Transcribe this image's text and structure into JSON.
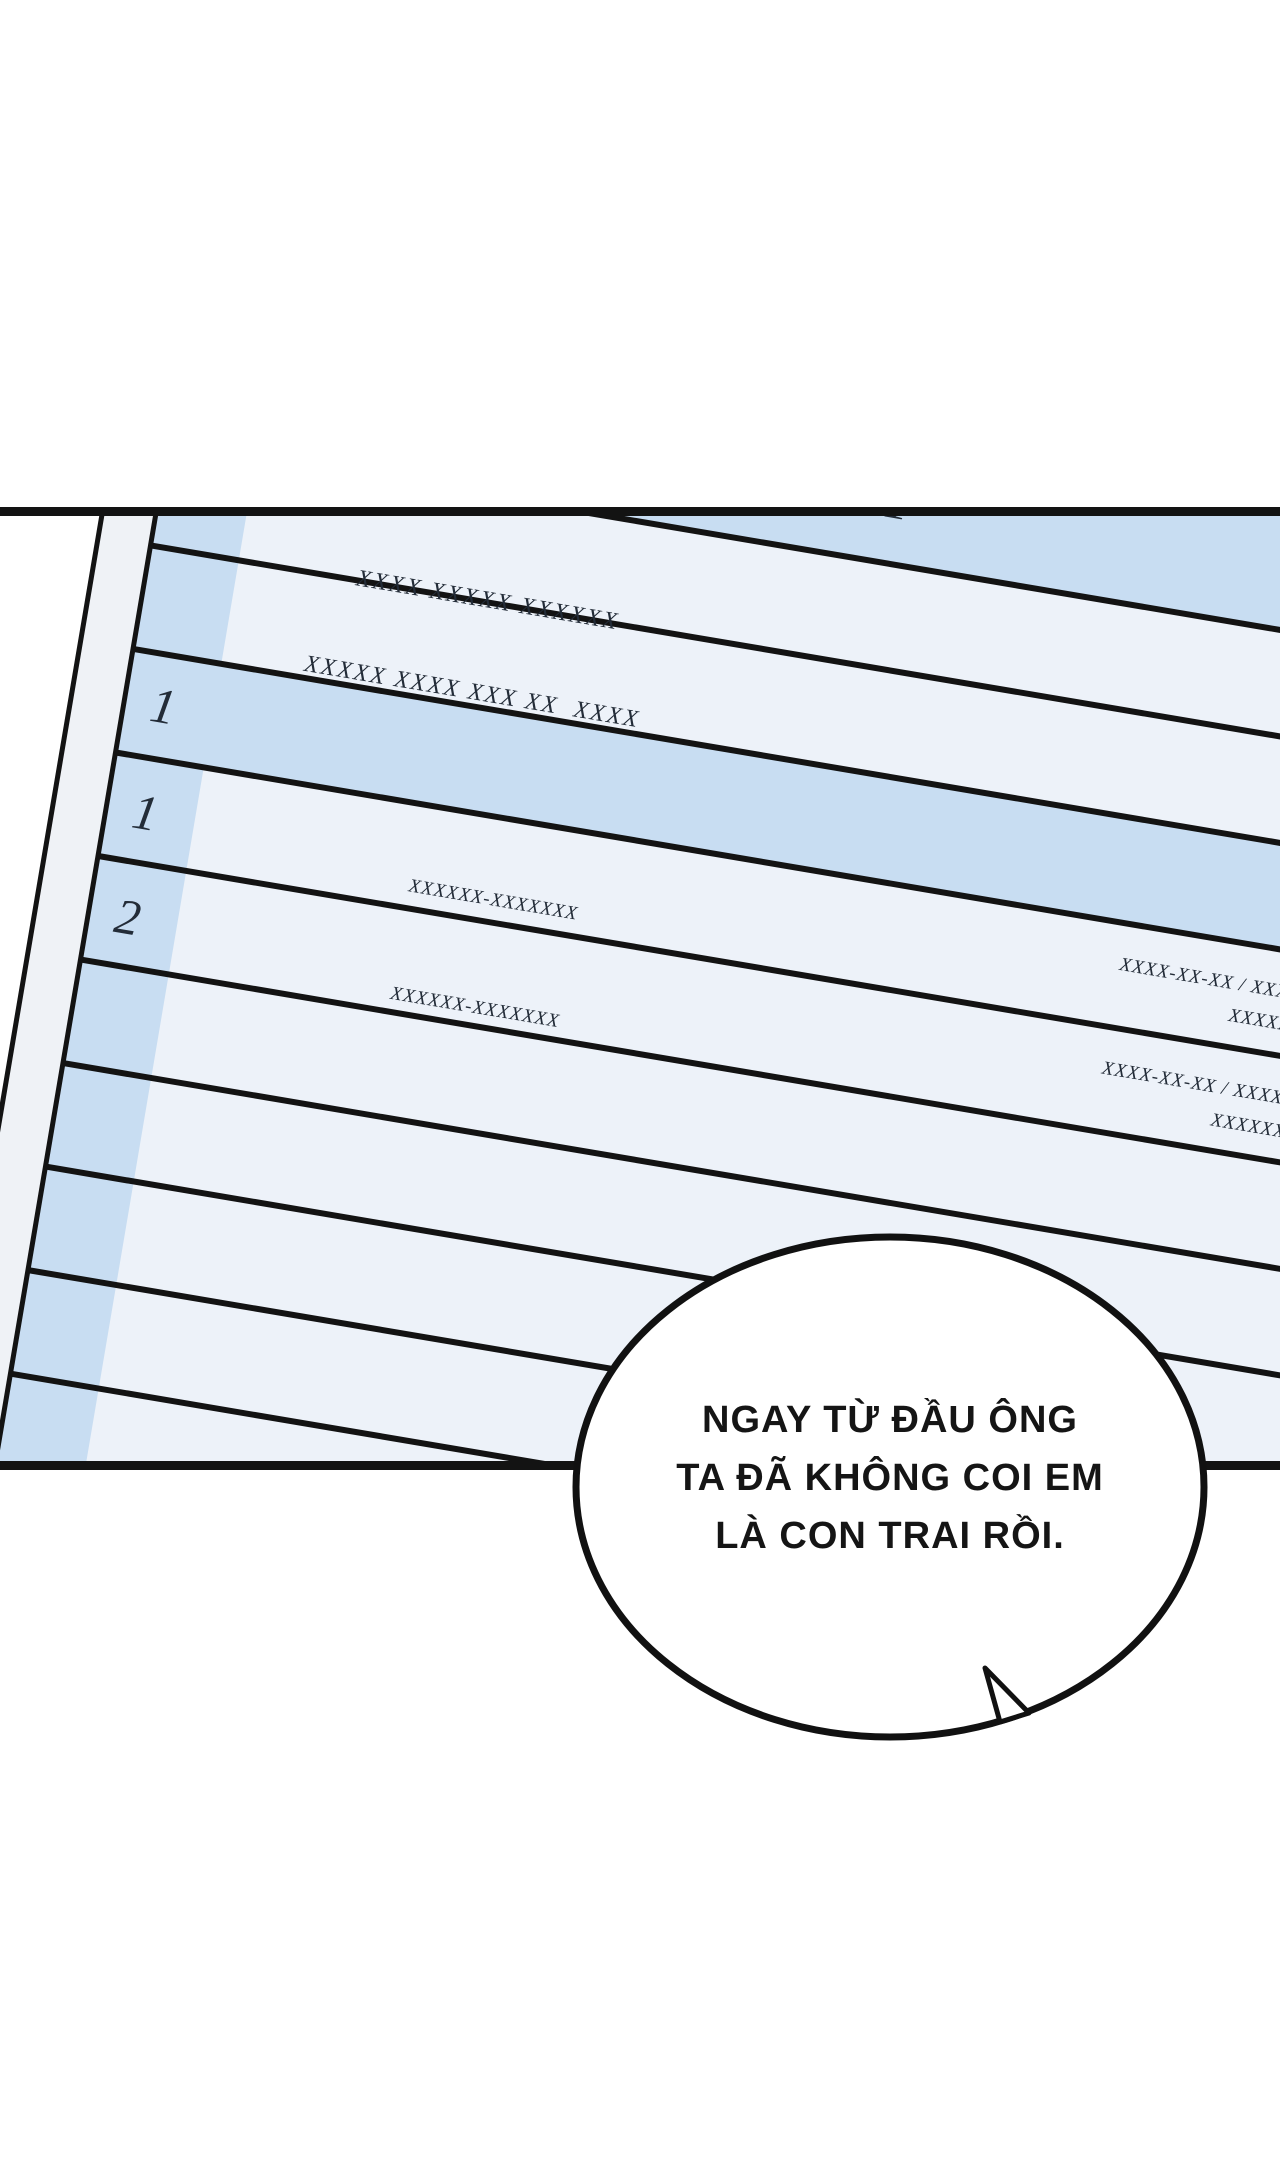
{
  "document": {
    "header": {
      "index_fragment": "2.",
      "top_fragment": "1",
      "line1": "XXXX XXXXX XXXXXX",
      "line2": "XXXXX XXXX XXX XX  XXXX"
    },
    "rows": [
      {
        "num": "1",
        "id": "",
        "date_line1": "",
        "date_line2": ""
      },
      {
        "num": "1",
        "id": "XXXXXX-XXXXXXX",
        "date_line1": "XXXX-XX-XX / XXXX",
        "date_line2": "XXXXXX"
      },
      {
        "num": "2",
        "id": "XXXXXX-XXXXXXX",
        "date_line1": "XXXX-XX-XX / XXXX",
        "date_line2": "XXXXXX"
      }
    ]
  },
  "speech_bubble": {
    "line1": "NGAY TỪ ĐẦU ÔNG",
    "line2": "TA ĐÃ KHÔNG COI EM",
    "line3": "LÀ CON TRAI RỒI."
  },
  "colors": {
    "paper_blue": "#c8ddf2",
    "row_pale": "#edf2f9",
    "paper_margin": "#eff2f6",
    "line_ink": "#131313",
    "text_ink": "#232c38"
  }
}
